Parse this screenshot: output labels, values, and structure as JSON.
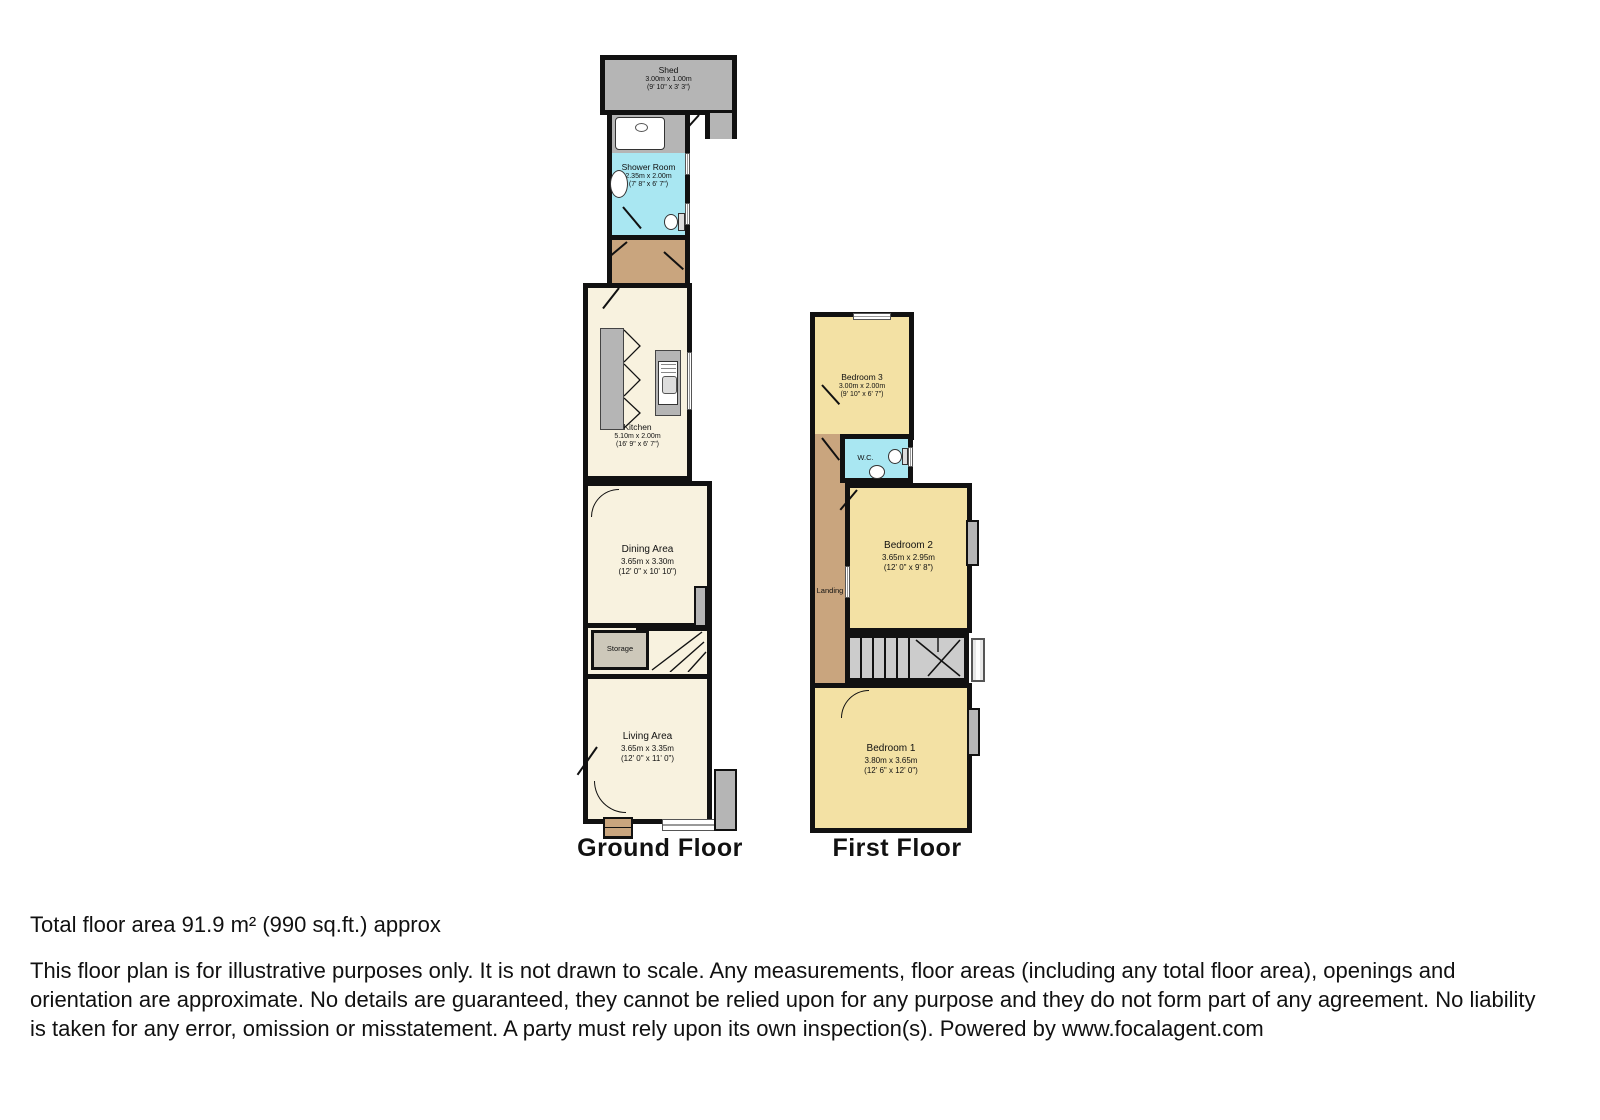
{
  "palette": {
    "wall": "#111111",
    "cream": "#f8f2df",
    "yellow": "#f3e1a4",
    "cyan": "#a9e7f2",
    "tan": "#c9a57e",
    "gray": "#b5b5b5",
    "storage": "#cdc8ba",
    "stair": "#cccccc",
    "window": "#e0e0e0"
  },
  "floors": {
    "ground": {
      "title": "Ground Floor",
      "rooms": {
        "shed": {
          "name": "Shed",
          "metric": "3.00m x 1.00m",
          "imperial": "(9' 10\" x 3' 3\")"
        },
        "shower": {
          "name": "Shower Room",
          "metric": "2.35m x 2.00m",
          "imperial": "(7' 8\" x 6' 7\")"
        },
        "kitchen": {
          "name": "Kitchen",
          "metric": "5.10m x 2.00m",
          "imperial": "(16' 9\" x 6' 7\")"
        },
        "dining": {
          "name": "Dining Area",
          "metric": "3.65m x 3.30m",
          "imperial": "(12' 0\" x 10' 10\")"
        },
        "storage": {
          "name": "Storage"
        },
        "living": {
          "name": "Living Area",
          "metric": "3.65m x 3.35m",
          "imperial": "(12' 0\" x 11' 0\")"
        }
      }
    },
    "first": {
      "title": "First Floor",
      "rooms": {
        "bedroom3": {
          "name": "Bedroom 3",
          "metric": "3.00m x 2.00m",
          "imperial": "(9' 10\" x 6' 7\")"
        },
        "wc": {
          "name": "W.C."
        },
        "landing": {
          "name": "Landing"
        },
        "bedroom2": {
          "name": "Bedroom 2",
          "metric": "3.65m x 2.95m",
          "imperial": "(12' 0\" x 9' 8\")"
        },
        "bedroom1": {
          "name": "Bedroom 1",
          "metric": "3.80m x 3.65m",
          "imperial": "(12' 6\" x 12' 0\")"
        }
      }
    }
  },
  "footer": {
    "total_area": "Total floor area 91.9 m² (990 sq.ft.) approx",
    "disclaimer": "This floor plan is for illustrative purposes only. It is not drawn to scale. Any measurements, floor areas (including any total floor area), openings and orientation are approximate. No details are guaranteed, they cannot be relied upon for any purpose and they do not form part of any agreement. No liability is taken for any error, omission or misstatement. A party must rely upon its own inspection(s). Powered by www.focalagent.com"
  }
}
